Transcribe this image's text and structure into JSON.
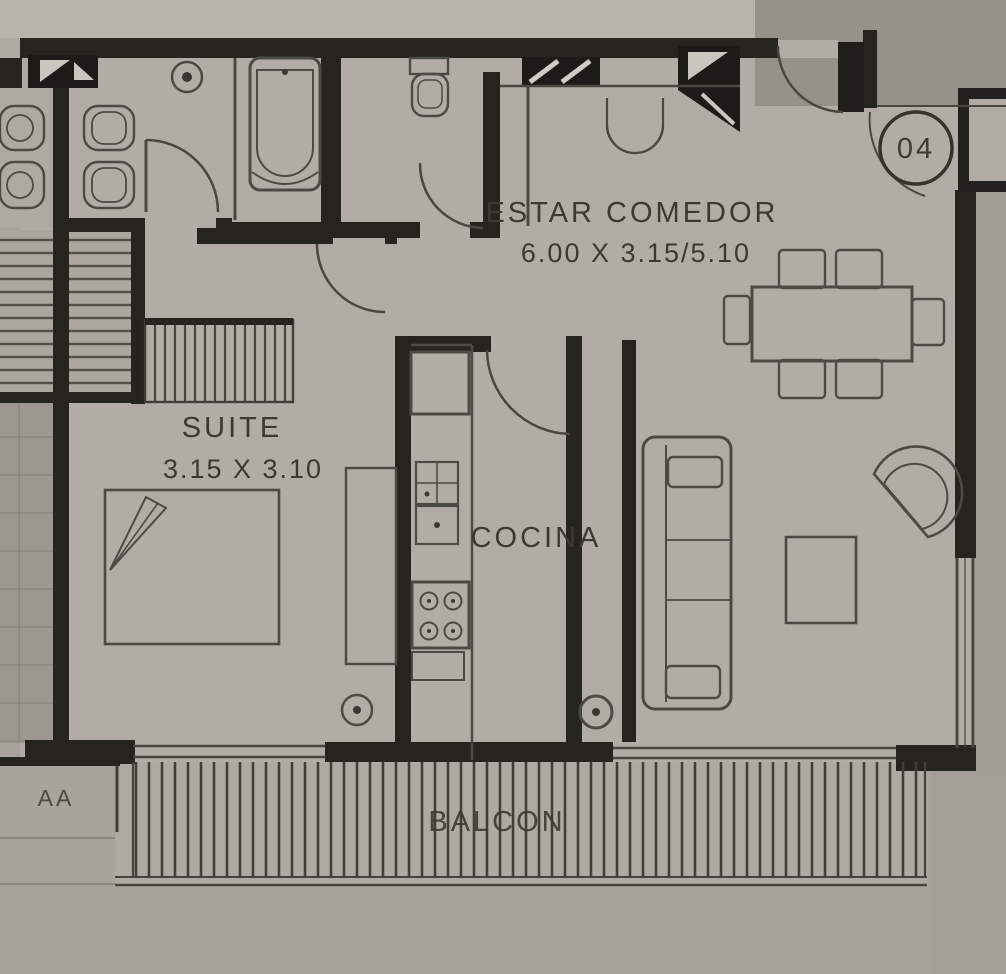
{
  "plan": {
    "unit_number": "04",
    "section_marker": "AA",
    "rooms": [
      {
        "id": "estar-comedor",
        "label": "ESTAR COMEDOR",
        "dimensions": "6.00 X 3.15/5.10"
      },
      {
        "id": "suite",
        "label": "SUITE",
        "dimensions": "3.15 X 3.10"
      },
      {
        "id": "cocina",
        "label": "COCINA"
      },
      {
        "id": "balcon",
        "label": "BALCON"
      }
    ],
    "colors": {
      "paper": "#b1ada6",
      "paper_light": "#b8b4ad",
      "exterior_corridor": "#96928b",
      "wall": "#26241f",
      "line": "#4a4741",
      "text": "#3b3931"
    }
  }
}
